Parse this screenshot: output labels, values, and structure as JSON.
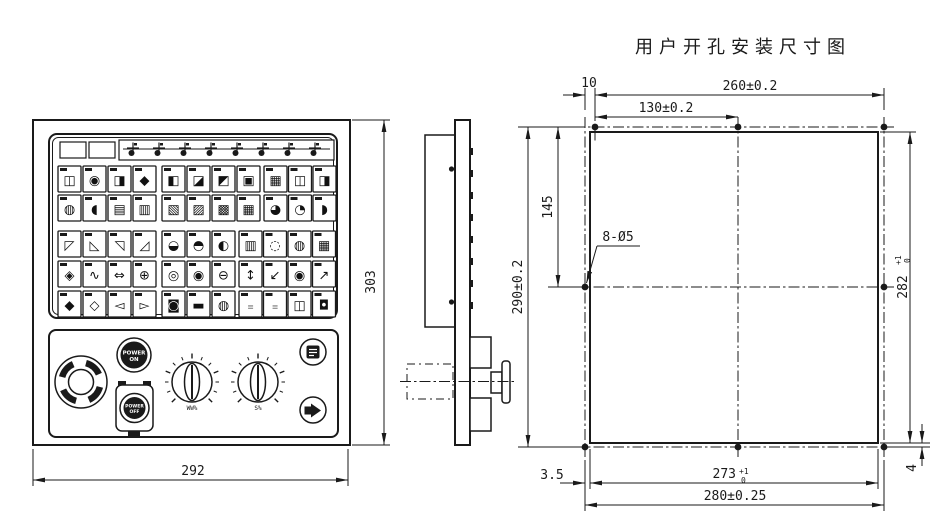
{
  "page_title": "用户开孔安装尺寸图",
  "front_view": {
    "dim_width": "292",
    "dim_height": "303",
    "power_on_line1": "POWER",
    "power_on_line2": "ON",
    "power_off_line1": "POWER",
    "power_off_line2": "OFF",
    "knob_left_label": "WW%",
    "knob_right_label": "S%"
  },
  "keypad": {
    "indicator_windows": 2,
    "strip_icons": [
      "mode-indicator-icon",
      "mode-indicator-icon",
      "mode-indicator-icon",
      "mode-indicator-icon",
      "mode-indicator-icon",
      "mode-indicator-icon",
      "mode-indicator-icon",
      "mode-indicator-icon"
    ],
    "rows": [
      [
        [
          "◫",
          "◉",
          "◨",
          "◆"
        ],
        [
          "◧",
          "◪",
          "◩",
          "▣"
        ],
        [
          "▦",
          "◫",
          "◨"
        ]
      ],
      [
        [
          "◍",
          "◖",
          "▤",
          "▥"
        ],
        [
          "▧",
          "▨",
          "▩",
          "▦"
        ],
        [
          "◕",
          "◔",
          "◗"
        ]
      ],
      [
        [
          "◸",
          "◺",
          "◹",
          "◿"
        ],
        [
          "◒",
          "◓",
          "◐"
        ],
        [
          "▥",
          "◌",
          "◍",
          "▦"
        ]
      ],
      [
        [
          "◈",
          "∿",
          "⇔",
          "⊕"
        ],
        [
          "◎",
          "◉",
          "⊖"
        ],
        [
          "↕",
          "↙",
          "◉",
          "↗"
        ]
      ],
      [
        [
          "◆",
          "◇",
          "◅",
          "▻"
        ],
        [
          "◙",
          "▬",
          "◍"
        ],
        [
          "≡",
          "≡",
          "◫",
          "◘"
        ]
      ]
    ]
  },
  "cutout_view": {
    "dim_offset_top": "10",
    "dim_top_span": "260±0.2",
    "dim_top_half": "130±0.2",
    "dim_side_hole_y": "145",
    "holes_label": "8-Ø5",
    "dim_pattern_height": "290±0.2",
    "cutout_height": "282",
    "cutout_height_tol_upper": "+1",
    "cutout_height_tol_lower": "0",
    "dim_corner_offset": "4",
    "dim_edge_offset": "3.5",
    "cutout_width": "273",
    "cutout_width_tol_upper": "+1",
    "cutout_width_tol_lower": "0",
    "dim_bottom_span": "280±0.25"
  },
  "colors": {
    "line": "#1a1a1a",
    "paper": "#ffffff"
  }
}
